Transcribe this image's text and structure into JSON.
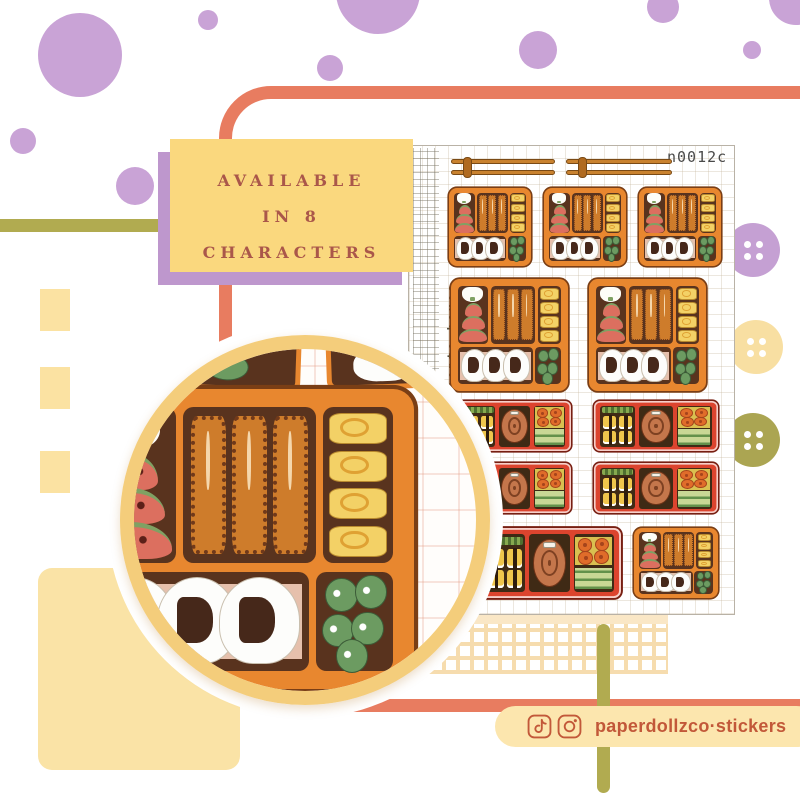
{
  "title": "bento boxes sticker sheet product graphic",
  "banner": {
    "lines": [
      "AVAILABLE",
      "IN 8",
      "CHARACTERS"
    ]
  },
  "sheet": {
    "code": "n0012c",
    "side_label": "bento boxes"
  },
  "social": {
    "handle": "paperdollzco·stickers",
    "icons": [
      "tiktok-icon",
      "instagram-icon"
    ]
  },
  "colors": {
    "lilac": "#C9A3D6",
    "banner_purple": "#BE97CD",
    "banner_yellow": "#FAD87E",
    "banner_text": "#AA574A",
    "coral": "#E87C60",
    "olive": "#B1AB50",
    "pale_yellow": "#FBE2A2",
    "cream": "#FAE3A6",
    "pill_bg": "#FCE6AE",
    "pill_text": "#C25839",
    "bento_orange": "#E8872F",
    "bento_red": "#DC442E",
    "bento_interior": "#59331E",
    "ring_gold": "#F4CD7B"
  },
  "decor": {
    "dots": [
      {
        "x": 80,
        "y": 55,
        "r": 42
      },
      {
        "x": 208,
        "y": 20,
        "r": 10
      },
      {
        "x": 330,
        "y": 68,
        "r": 13
      },
      {
        "x": 23,
        "y": 141,
        "r": 13
      },
      {
        "x": 135,
        "y": 186,
        "r": 19
      },
      {
        "x": 378,
        "y": -8,
        "r": 42
      },
      {
        "x": 538,
        "y": 50,
        "r": 19
      },
      {
        "x": 663,
        "y": 7,
        "r": 16
      },
      {
        "x": 752,
        "y": 50,
        "r": 9
      },
      {
        "x": 796,
        "y": -2,
        "r": 27
      }
    ],
    "yellow_squares": [
      {
        "x": 40,
        "y": 289,
        "w": 30,
        "h": 42
      },
      {
        "x": 40,
        "y": 367,
        "w": 30,
        "h": 42
      },
      {
        "x": 40,
        "y": 451,
        "w": 30,
        "h": 42
      }
    ],
    "buttons": [
      {
        "x": 753,
        "y": 250,
        "r": 27,
        "c": "#C5A0D3"
      },
      {
        "x": 756,
        "y": 347,
        "r": 27,
        "c": "#F8DFA2"
      },
      {
        "x": 753,
        "y": 440,
        "r": 27,
        "c": "#ABA552"
      }
    ]
  },
  "stickers": {
    "chopsticks": [
      {
        "x": 42,
        "y": 11,
        "w": 104,
        "h": 22
      },
      {
        "x": 157,
        "y": 11,
        "w": 106,
        "h": 22
      }
    ],
    "orange_small": [
      {
        "x": 40,
        "y": 42,
        "w": 82,
        "h": 78
      },
      {
        "x": 135,
        "y": 42,
        "w": 82,
        "h": 78
      },
      {
        "x": 230,
        "y": 42,
        "w": 82,
        "h": 78
      },
      {
        "x": 225,
        "y": 382,
        "w": 84,
        "h": 70
      }
    ],
    "orange_large": [
      {
        "x": 42,
        "y": 133,
        "w": 117,
        "h": 112
      },
      {
        "x": 180,
        "y": 133,
        "w": 117,
        "h": 112
      }
    ],
    "red_wide": [
      {
        "x": 49,
        "y": 255,
        "w": 113,
        "h": 50
      },
      {
        "x": 185,
        "y": 255,
        "w": 124,
        "h": 50
      },
      {
        "x": 49,
        "y": 317,
        "w": 113,
        "h": 50
      },
      {
        "x": 185,
        "y": 317,
        "w": 124,
        "h": 50
      }
    ],
    "red_big": [
      {
        "x": 69,
        "y": 382,
        "w": 143,
        "h": 70
      }
    ]
  }
}
